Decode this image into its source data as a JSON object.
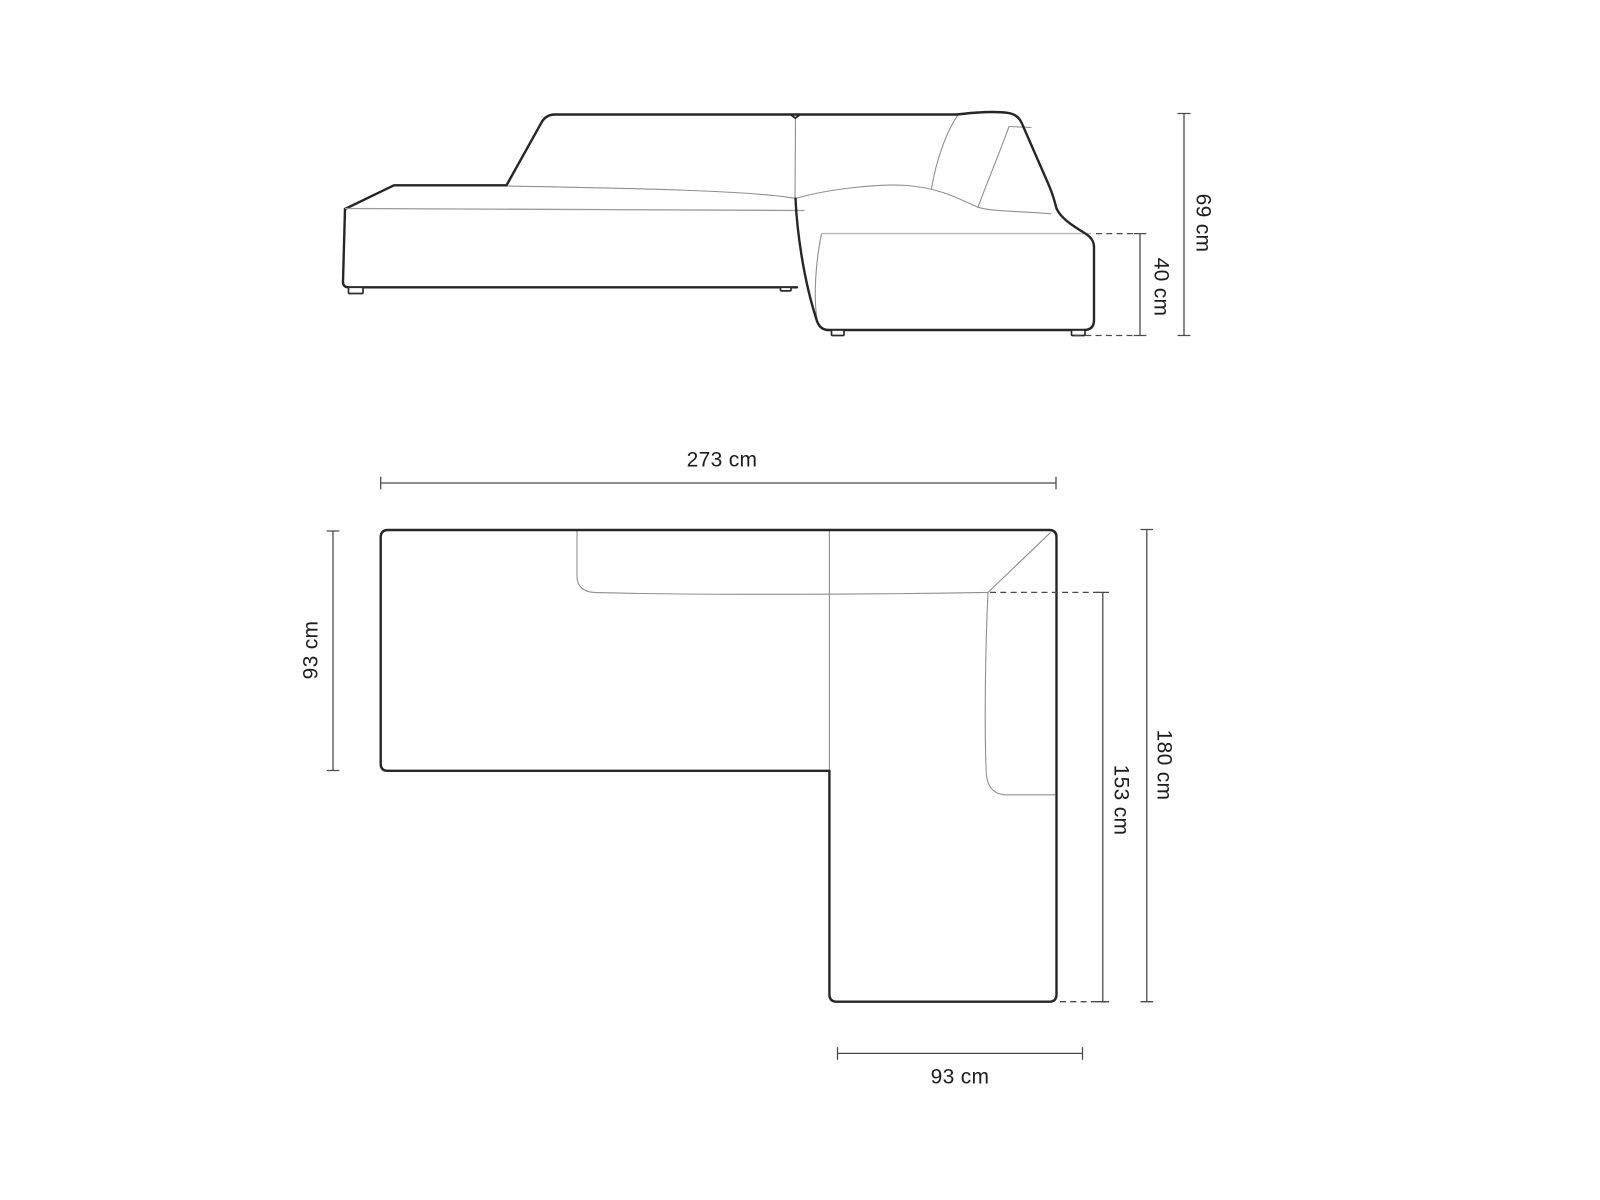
{
  "diagram": {
    "type": "furniture-dimension-drawing",
    "views": {
      "elevation": "side view of modular corner sofa",
      "plan": "top view of L-shaped corner sofa"
    }
  },
  "dimensions": {
    "elevation_total_height": "69 cm",
    "elevation_seat_height": "40 cm",
    "plan_total_width": "273 cm",
    "plan_left_depth": "93 cm",
    "plan_right_depth": "180 cm",
    "plan_chaise_inner_length": "153 cm",
    "plan_chaise_width": "93 cm"
  },
  "colors": {
    "background": "#ffffff",
    "sofa_outline": "#262626",
    "seam_line": "#8f8f8f",
    "light_edge": "#b9b9b9",
    "dimension_line": "#4a4a4a",
    "label_text": "#1d1d1d"
  }
}
